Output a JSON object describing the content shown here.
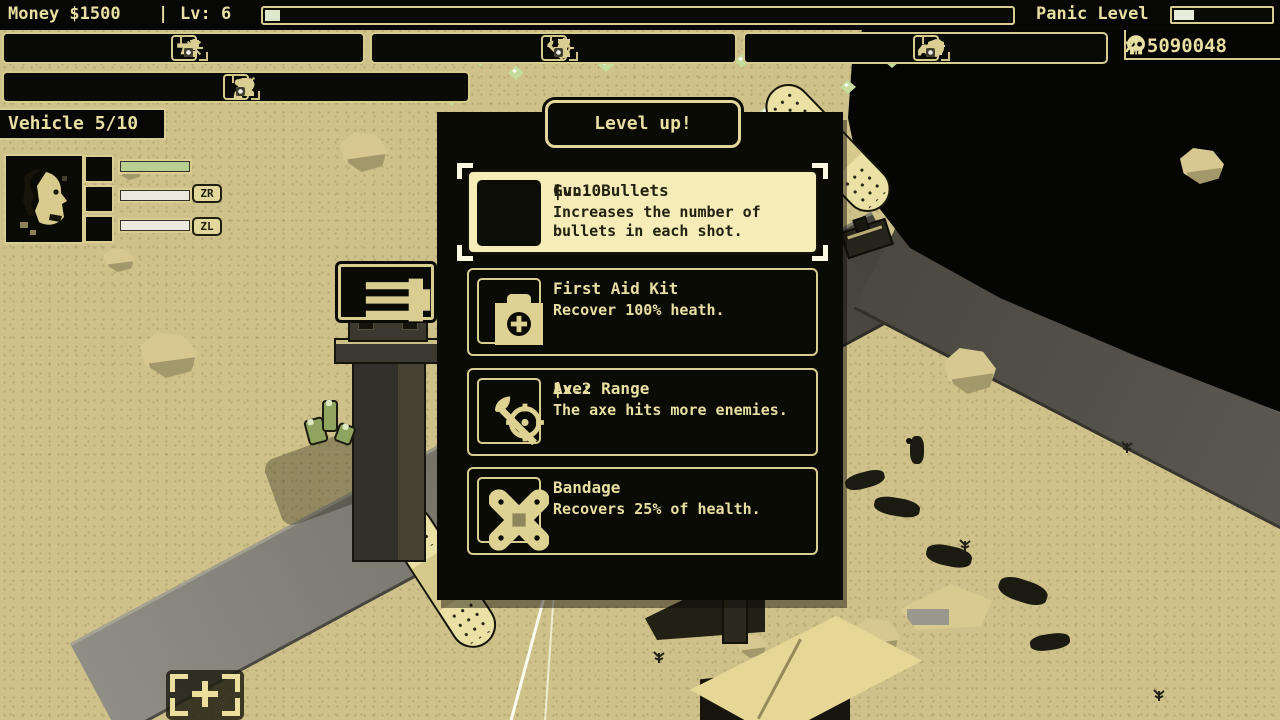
{
  "hud": {
    "money_label": "Money $1500",
    "separator": "|",
    "level_label": "Lv: 6",
    "xp_progress_pct": 2,
    "panic_label": "Panic Level",
    "panic_progress_pct": 20,
    "kill_counter": "x 5090048",
    "kill_icon": "skull-icon",
    "vehicle_label": "Vehicle 5/10"
  },
  "toolbar": {
    "groups": [
      {
        "name": "gun",
        "icon": "pistol-icon",
        "items": [
          {
            "icon": "bullet-icon",
            "level": 9,
            "max": 10
          },
          {
            "icon": "grip-icon",
            "level": 4,
            "max": 10
          },
          {
            "icon": "burst-icon",
            "level": 3,
            "max": 10
          }
        ]
      },
      {
        "name": "axe",
        "icon": "axe-icon",
        "items": [
          {
            "icon": "lightning-icon",
            "level": 1,
            "max": 10
          },
          {
            "icon": "hourglass-icon",
            "level": 1,
            "max": 10
          },
          {
            "icon": "crosshair-icon",
            "level": 1,
            "max": 10
          }
        ]
      },
      {
        "name": "car",
        "icon": "car-icon",
        "items": [
          {
            "icon": "shield-icon",
            "level": 1,
            "max": 10
          },
          {
            "icon": "wrench-icon",
            "level": 1,
            "max": 10
          },
          {
            "icon": "turret-icon",
            "level": 1,
            "max": 10
          }
        ]
      },
      {
        "name": "character",
        "icon": "person-icon",
        "items": [
          {
            "icon": "boot-icon",
            "level": 4,
            "max": 10
          },
          {
            "icon": "vest-icon",
            "level": 10,
            "max": 10
          },
          {
            "icon": "heart-icon",
            "level": 10,
            "max": 10
          },
          {
            "icon": "bomb-icon",
            "level": 1,
            "max": 10
          }
        ]
      }
    ]
  },
  "character_panel": {
    "buttons": {
      "zr": "ZR",
      "zl": "ZL"
    },
    "bars": [
      {
        "icon": "heart-icon",
        "fill_pct": 100,
        "color": "#b7cf90"
      },
      {
        "icon": "pistol-icon",
        "fill_pct": 100,
        "color": "#eceade"
      },
      {
        "icon": "axe-icon",
        "fill_pct": 100,
        "color": "#eceade"
      }
    ]
  },
  "levelup": {
    "title": "Level up!",
    "options": [
      {
        "icon": "bullets3-icon",
        "title": "Gun: Bullets",
        "separator": "|",
        "level": "Lv.10",
        "desc": "Increases the number of bullets in each shot.",
        "selected": true
      },
      {
        "icon": "firstaid-icon",
        "title": "First Aid Kit",
        "separator": "",
        "level": "",
        "desc": "Recover 100% heath.",
        "selected": false
      },
      {
        "icon": "axerange-icon",
        "title": "Axe: Range",
        "separator": "|",
        "level": "Lv.2",
        "desc": "The axe hits more enemies.",
        "selected": false
      },
      {
        "icon": "bandage-icon",
        "title": "Bandage",
        "separator": "",
        "level": "",
        "desc": "Recovers 25% of health.",
        "selected": false
      }
    ]
  },
  "colors": {
    "cream": "#e8dfa2",
    "desert": "#cec189",
    "selected_bg": "#f5ecb8",
    "bar_green": "#b7cf90",
    "bar_white": "#eceade",
    "road_dark": "#44423a",
    "road_light": "#908e84",
    "gem_green": "#c6dc9c",
    "hud_black": "#070705"
  }
}
